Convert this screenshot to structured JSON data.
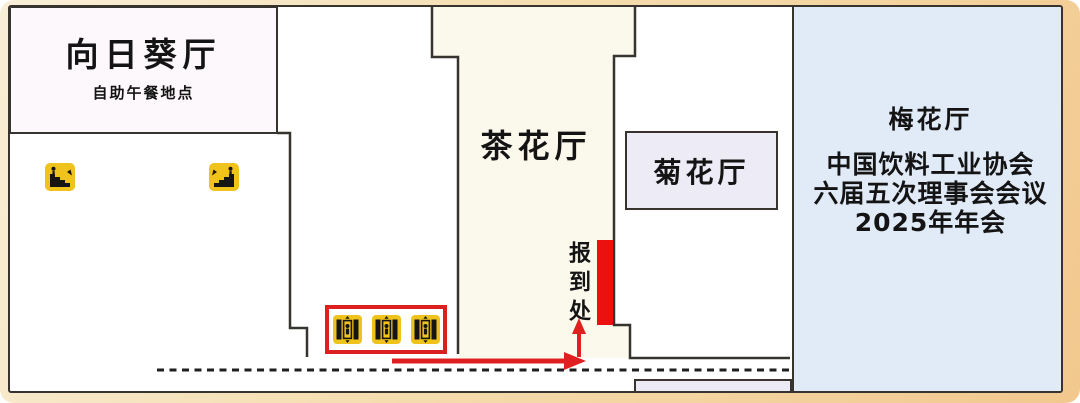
{
  "floor_plan": {
    "rooms": {
      "sunflower_hall": {
        "name": "向日葵厅",
        "subtitle": "自助午餐地点"
      },
      "camellia_hall": {
        "name": "茶花厅"
      },
      "chrysanthemum_hall": {
        "name": "菊花厅"
      },
      "plum_hall": {
        "name": "梅花厅",
        "event_line1": "中国饮料工业协会",
        "event_line2": "六届五次理事会会议",
        "event_line3": "2025年年会"
      }
    },
    "markers": {
      "registration_desk": "报到处"
    },
    "icons": {
      "escalator_down": "escalator-down-icon",
      "escalator_up": "escalator-up-icon",
      "elevator": "elevator-icon",
      "elevator_count": "3"
    },
    "colors": {
      "frame_tan": "#f2c88e",
      "plum_area_blue": "#e1eaf7",
      "corridor_cream": "#fbf8ec",
      "chrys_lavender": "#edecf6",
      "registration_red": "#ec1111",
      "route_arrow_red": "#e02020",
      "icon_yellow": "#f0c31c",
      "wall_dark": "#37332e"
    }
  }
}
